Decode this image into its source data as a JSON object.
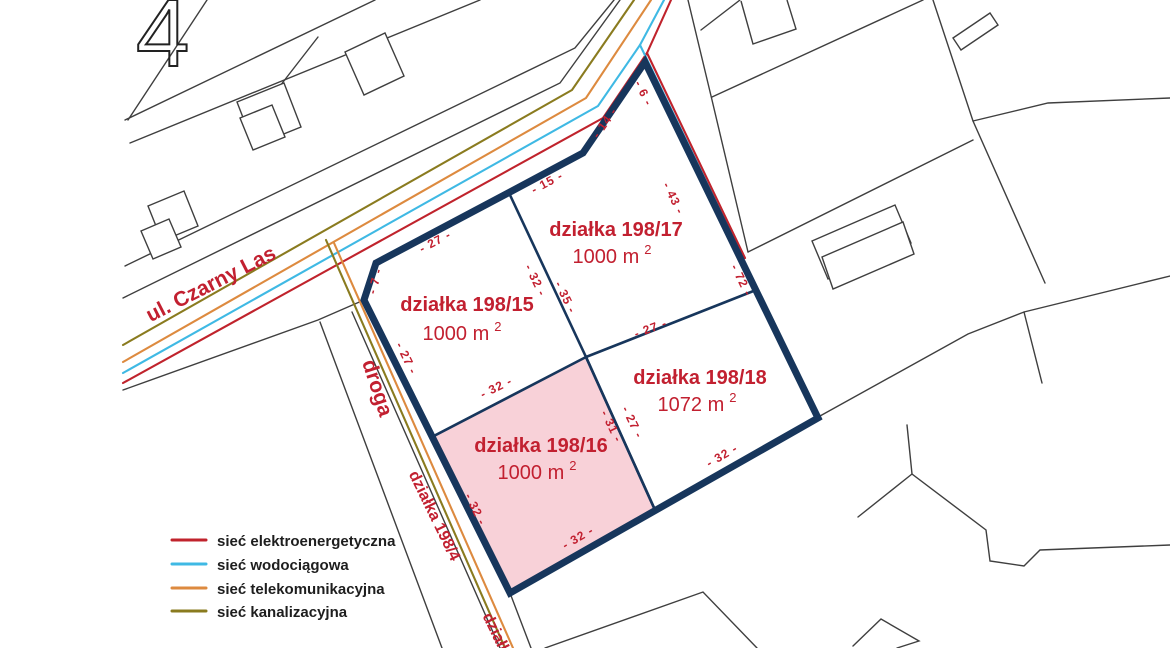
{
  "sheet": {
    "digit": "4"
  },
  "streets": {
    "main_road": "ul. Czarny Las",
    "access_road": "droga",
    "access_road_parcel": "działka 198/4",
    "access_road_parcel_bottom": "działka"
  },
  "parcels": [
    {
      "name": "działka 198/15",
      "area": "1000 m",
      "area_sup": "2",
      "highlighted": false
    },
    {
      "name": "działka 198/17",
      "area": "1000 m",
      "area_sup": "2",
      "highlighted": false
    },
    {
      "name": "działka 198/18",
      "area": "1072 m",
      "area_sup": "2",
      "highlighted": false
    },
    {
      "name": "działka 198/16",
      "area": "1000 m",
      "area_sup": "2",
      "highlighted": true
    }
  ],
  "dimensions": [
    {
      "text": "- 14 -"
    },
    {
      "text": "- 6 -"
    },
    {
      "text": "- 15 -"
    },
    {
      "text": "- 27 -"
    },
    {
      "text": "- 7 -"
    },
    {
      "text": "- 27 -"
    },
    {
      "text": "- 32 -"
    },
    {
      "text": "- 32 -"
    },
    {
      "text": "- 35 -"
    },
    {
      "text": "- 27 -"
    },
    {
      "text": "- 31 -"
    },
    {
      "text": "- 27 -"
    },
    {
      "text": "- 43 -"
    },
    {
      "text": "- 72 -"
    },
    {
      "text": "- 32 -"
    },
    {
      "text": "- 32 -"
    },
    {
      "text": "- 32 -"
    }
  ],
  "legend": {
    "items": [
      {
        "label": "sieć elektroenergetyczna",
        "color": "#c0232c"
      },
      {
        "label": "sieć wodociągowa",
        "color": "#3fb9e4"
      },
      {
        "label": "sieć telekomunikacyjna",
        "color": "#dd8a3f"
      },
      {
        "label": "sieć kanalizacyjna",
        "color": "#8a7b1f"
      }
    ]
  },
  "colors": {
    "boundary_navy": "#17365c",
    "highlight_pink": "#f8d1d8",
    "label_red": "#c22030",
    "parcel_line": "#3f3f3f",
    "electric": "#c0232c",
    "water": "#3fb9e4",
    "telecom": "#dd8a3f",
    "sewer": "#8a7b1f"
  }
}
